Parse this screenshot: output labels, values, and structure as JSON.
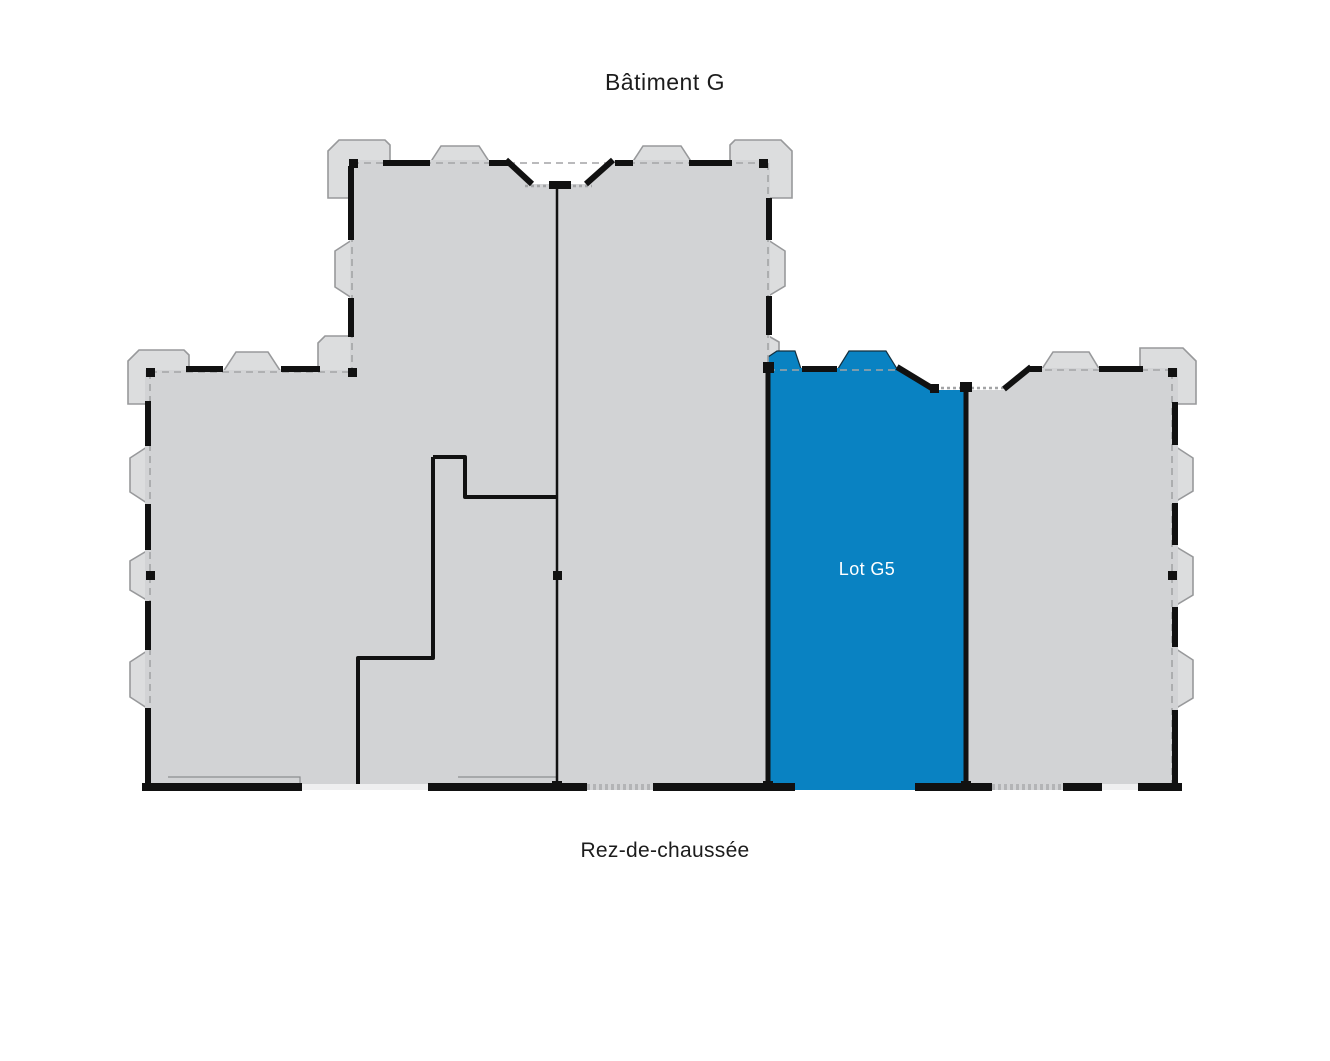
{
  "title": "Bâtiment G",
  "floor_label": "Rez-de-chaussée",
  "building": "G",
  "lots": [
    {
      "id": "G5",
      "label": "Lot G5",
      "highlighted": true
    }
  ],
  "colors": {
    "background": "#ffffff",
    "unit_fill": "#d2d3d5",
    "bay_fill": "#dcddde",
    "bay_stroke": "#98999b",
    "wall": "#111111",
    "dashed": "#a3a4a6",
    "highlight": "#0982c2",
    "highlight_label": "#ffffff",
    "text": "#1c1c1c"
  }
}
